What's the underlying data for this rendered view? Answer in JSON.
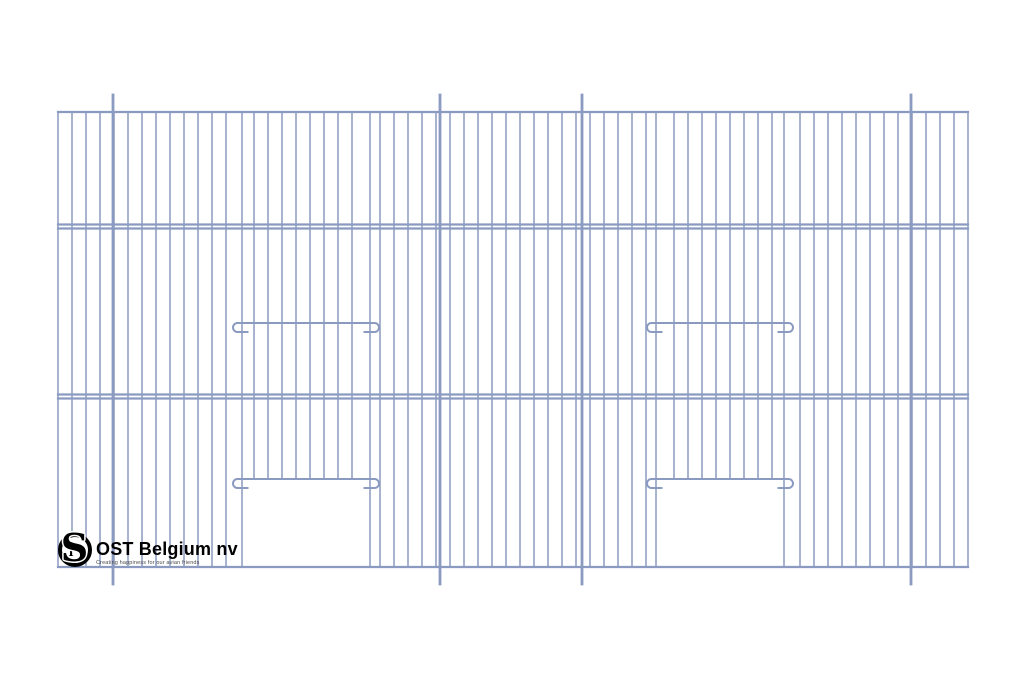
{
  "brand": {
    "name": "OST Belgium nv",
    "tagline": "Creating happiness for our avian friends",
    "monogram": {
      "s": "S",
      "t": "T"
    }
  },
  "drawing": {
    "type": "bird-cage-front-panel-line-drawing",
    "background": "#ffffff",
    "wire_color": "#8b9ac0",
    "canvas": {
      "width": 1024,
      "height": 683
    },
    "frame": {
      "left": 58,
      "right": 968,
      "top": 112,
      "bottom": 567
    },
    "wire_spacing": 14,
    "wire_stroke": 1.5,
    "rail_stroke": 2.2,
    "rails_y": [
      112,
      224.5,
      228.5,
      394.5,
      398.5,
      567
    ],
    "posts": {
      "xs": [
        113,
        440,
        582,
        911
      ],
      "top": 95,
      "bottom": 584,
      "stroke": 2.8
    },
    "doors": [
      {
        "left": 242,
        "right": 370,
        "bar_y": 479
      },
      {
        "left": 656,
        "right": 784,
        "bar_y": 479
      }
    ],
    "perch_bars": [
      {
        "left": 233,
        "right": 379,
        "y": 323
      },
      {
        "left": 647,
        "right": 793,
        "y": 323
      }
    ],
    "bar_overhang": 9,
    "bar_stroke": 2,
    "curl_radius": 4.5,
    "stub_length": 11,
    "edge_skip_tolerance": 5
  }
}
